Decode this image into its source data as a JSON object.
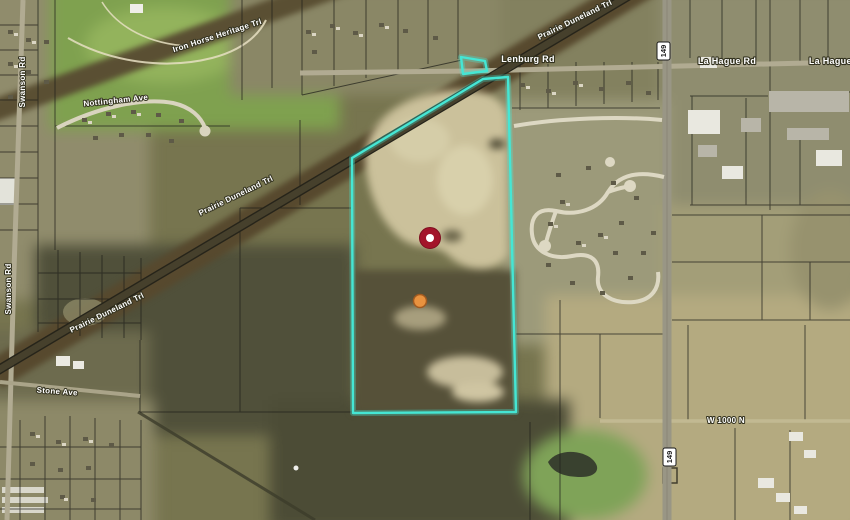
{
  "map": {
    "labels": {
      "lenburg_rd": "Lenburg Rd",
      "la_hague_rd_mid": "La Hague Rd",
      "la_hague_rd_east": "La Hague Rd",
      "w_1000_n": "W 1000 N",
      "stone_ave": "Stone Ave",
      "swanson_rd_north": "Swanson Rd",
      "swanson_rd_south": "Swanson Rd",
      "nottingham_ave": "Nottingham Ave",
      "iron_horse_heritage_trl": "Iron Horse Heritage Trl",
      "prairie_duneland_trl_ne": "Prairie Duneland Trl",
      "prairie_duneland_trl_mid": "Prairie Duneland Trl",
      "prairie_duneland_trl_sw": "Prairie Duneland Trl"
    },
    "route_shields": {
      "north": "149",
      "south": "149"
    },
    "parcel": {
      "outline_color": "#45e6d4"
    },
    "markers": {
      "primary": {
        "color": "#a3142a",
        "center_color": "#ffffff"
      },
      "secondary": {
        "color": "#e8923f",
        "border_color": "#a05a20"
      }
    }
  }
}
